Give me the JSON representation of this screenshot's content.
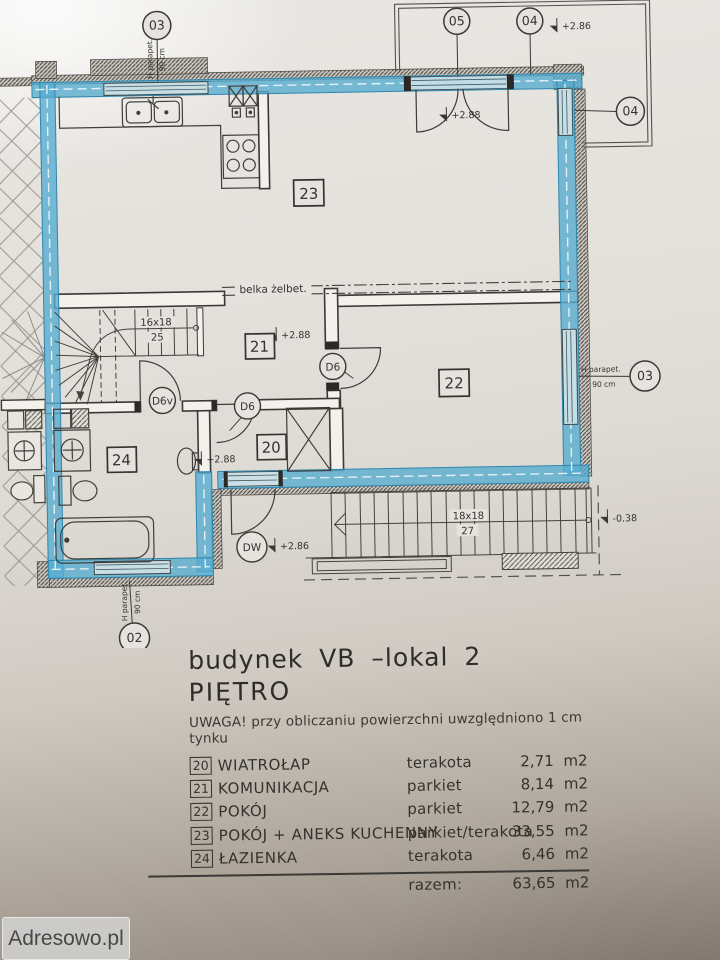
{
  "plan": {
    "markers": {
      "top_left": "03",
      "top_door": "05",
      "top_right": "04",
      "right_upper": "04",
      "right_lower": "03",
      "bottom_left": "02"
    },
    "levels": {
      "balcony": "+2.86",
      "balcony_door": "+2.88",
      "hall": "+2.88",
      "vestibule_door": "+2.88",
      "entry_landing": "+2.86",
      "stairs_exit": "-0.38"
    },
    "rooms": {
      "r20": "20",
      "r21": "21",
      "r22": "22",
      "r23": "23",
      "r24": "24"
    },
    "doors": {
      "room22": "D6",
      "room20": "D6",
      "bathroom": "D6v",
      "entrance": "DW"
    },
    "stairs": {
      "internal_size": "16x18",
      "internal_count": "25",
      "external_size": "18x18",
      "external_count": "27"
    },
    "beam_label": "belka żelbet.",
    "parapet_label": "H parapet.",
    "parapet_height": "90 cm"
  },
  "legend": {
    "title": "budynek VB –lokal 2",
    "floor": "PIĘTRO",
    "note": "UWAGA! przy obliczaniu powierzchni uwzględniono 1 cm tynku",
    "rows": [
      {
        "no": "20",
        "name": "WIATROŁAP",
        "finish": "terakota",
        "area": "2,71 m2"
      },
      {
        "no": "21",
        "name": "KOMUNIKACJA",
        "finish": "parkiet",
        "area": "8,14 m2"
      },
      {
        "no": "22",
        "name": "POKÓJ",
        "finish": "parkiet",
        "area": "12,79 m2"
      },
      {
        "no": "23",
        "name": "POKÓJ + ANEKS KUCHENNY",
        "finish": "parkiet/terakota",
        "area": "33,55 m2"
      },
      {
        "no": "24",
        "name": "ŁAZIENKA",
        "finish": "terakota",
        "area": "6,46 m2"
      }
    ],
    "total_label": "razem:",
    "total_area": "63,65 m2"
  },
  "watermark": {
    "label": "Adresowo.pl"
  },
  "colors": {
    "highlight": "#57acd0",
    "line": "#3b3935"
  }
}
